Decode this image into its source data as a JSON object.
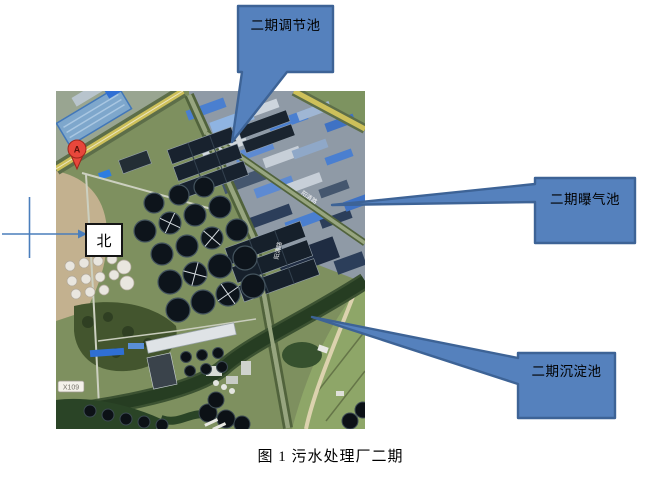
{
  "figure": {
    "caption": "图 1 污水处理厂二期"
  },
  "callouts": {
    "regulating": {
      "label": "二期调节池"
    },
    "aeration": {
      "label": "二期曝气池"
    },
    "sedimentation": {
      "label": "二期沉淀池"
    }
  },
  "map": {
    "north_label": "北",
    "marker_label": "A",
    "road_sign": "X109",
    "street_label": "阳清路"
  },
  "colors": {
    "callout_fill": "#5581BD",
    "callout_border": "#3D6396",
    "connector_blue": "#4A7EBC"
  }
}
